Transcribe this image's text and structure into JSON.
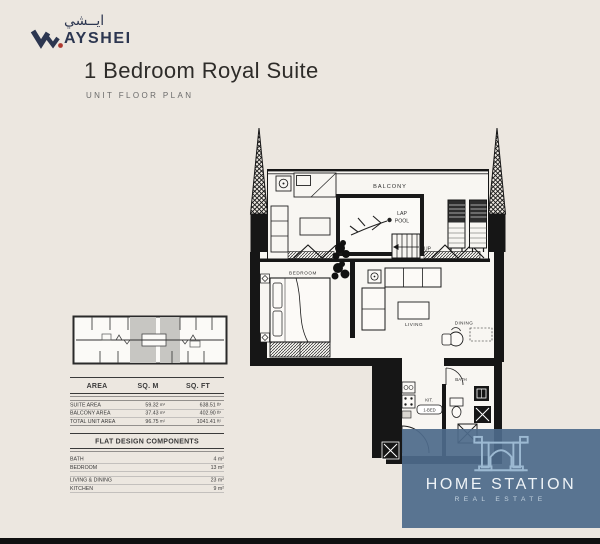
{
  "header": {
    "logo": {
      "arabic": "ايــشي",
      "name": "AYSHEI"
    },
    "title": "1 Bedroom Royal Suite",
    "subtitle": "UNIT FLOOR PLAN"
  },
  "area_table": {
    "headers": [
      "AREA",
      "SQ. M",
      "SQ. FT"
    ],
    "units": {
      "sqm": "m²",
      "sqft": "ft²"
    },
    "rows": [
      {
        "label": "SUITE AREA",
        "sqm": "59.32",
        "sqft": "638.51"
      },
      {
        "label": "BALCONY AREA",
        "sqm": "37.43",
        "sqft": "402.90"
      },
      {
        "label": "TOTAL UNIT AREA",
        "sqm": "96.75",
        "sqft": "1041.41"
      }
    ]
  },
  "components_table": {
    "title": "FLAT DESIGN COMPONENTS",
    "rows": [
      {
        "label": "BATH",
        "value": "4 m²"
      },
      {
        "label": "BEDROOM",
        "value": "13 m²"
      },
      {
        "label": "LIVING & DINING",
        "value": "23 m²"
      },
      {
        "label": "KITCHEN",
        "value": "9 m²"
      }
    ]
  },
  "floor_plan": {
    "labels": {
      "balcony": "BALCONY",
      "lap": "LAP",
      "pool": "POOL",
      "up": "UP",
      "bedroom": "BEDROOM",
      "living": "LIVING",
      "dining": "DINING",
      "kitchen": "KIT.",
      "unit_type": "1-BED",
      "bath": "BATH"
    }
  },
  "watermark": {
    "name": "HOME STATION",
    "tagline": "REAL ESTATE"
  },
  "colors": {
    "background": "#ece7e0",
    "ink": "#161616",
    "brand_navy": "#2c3650",
    "brand_red": "#ae3a30",
    "watermark_blue": "#4d6a8b"
  }
}
